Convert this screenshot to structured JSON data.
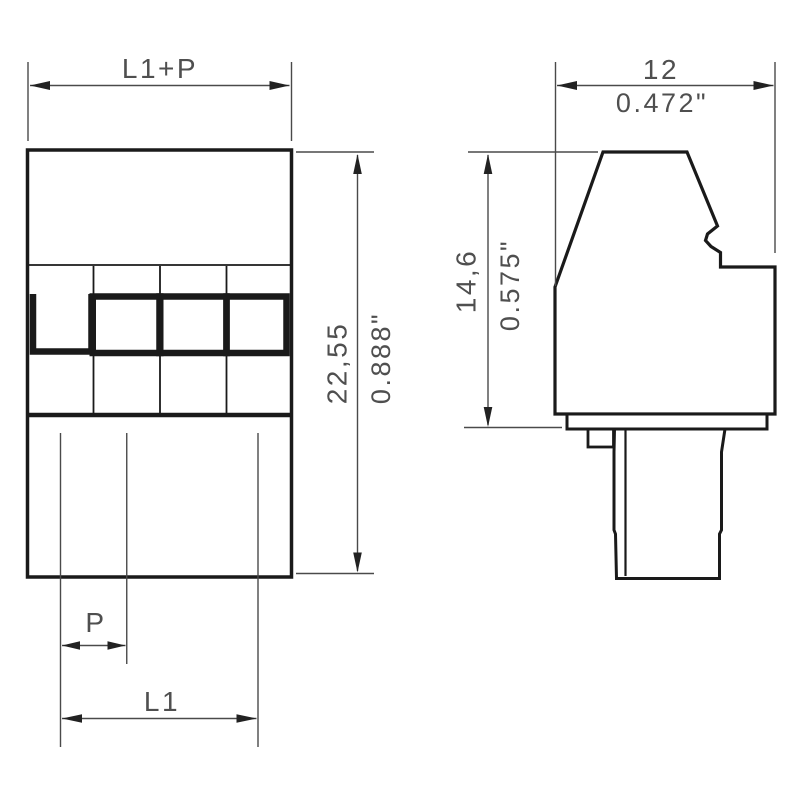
{
  "page": {
    "background": "#ffffff"
  },
  "colors": {
    "outline": "#1a1a1a",
    "dimension_lines": "#4a4a4a",
    "dimension_text": "#4f4f4f"
  },
  "front_view": {
    "poles": 4,
    "label_width_top": "L1+P",
    "label_height_mm": "22,55",
    "label_height_in": "0.888\"",
    "label_pitch": "P",
    "label_length": "L1"
  },
  "side_view": {
    "label_width_mm": "12",
    "label_width_in": "0.472\"",
    "label_height_mm": "14,6",
    "label_height_in": "0.575\""
  }
}
